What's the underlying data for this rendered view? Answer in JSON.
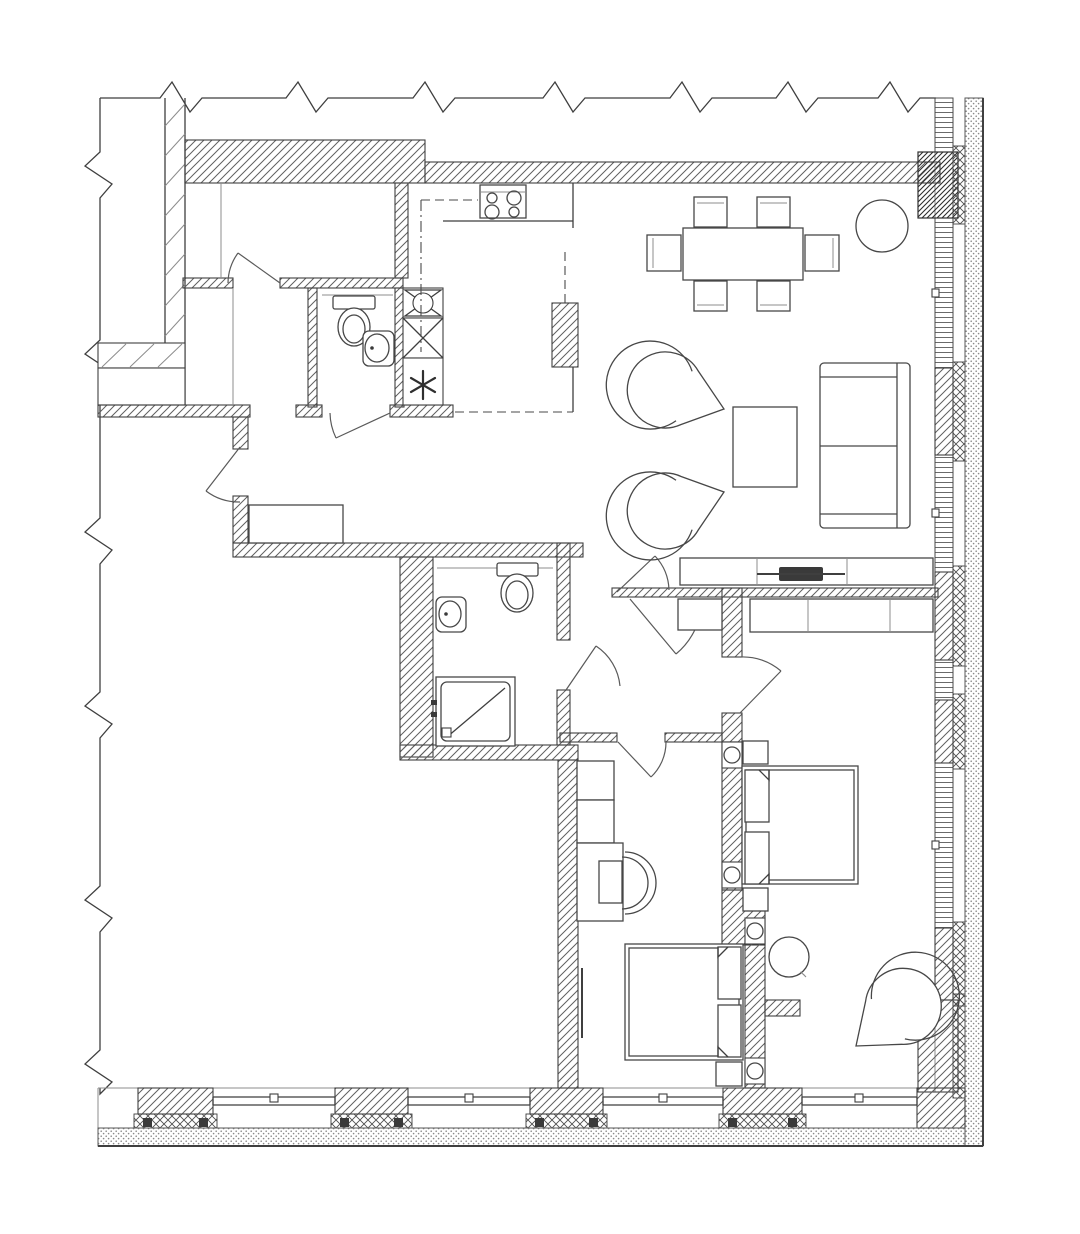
{
  "canvas": {
    "width": 1080,
    "height": 1234
  },
  "palette": {
    "paper": "#ffffff",
    "ink": "#3d3d3d",
    "ink_soft": "#8c8c8c",
    "hatch_line": "#636363",
    "dark_fill": "#3a3a3a"
  },
  "plan": {
    "description": "Apartment floor plan, black-and-white CAD drawing with hatched walls, window facade on right and bottom, break lines on top and left",
    "note_symbol": "six-point-asterisk",
    "wall_legend": [
      {
        "name": "masonry-wall",
        "fill": "diagonal-hatch"
      },
      {
        "name": "structural-pier",
        "fill": "dense-diagonal-hatch"
      },
      {
        "name": "insulation",
        "fill": "cross-hatch"
      },
      {
        "name": "exterior-cladding",
        "fill": "stipple-dots"
      },
      {
        "name": "window-band",
        "fill": "ladder-stripes"
      },
      {
        "name": "drawing-cut",
        "fill": "zigzag-break-line"
      }
    ],
    "fixtures": {
      "kitchen": [
        {
          "item": "cooktop-4-burner",
          "count": 1
        },
        {
          "item": "counter-run",
          "count": 1
        },
        {
          "item": "upper-cabinets-dashed",
          "count": 1
        },
        {
          "item": "ventilation-fan-shaft",
          "count": 1
        },
        {
          "item": "duct-shaft-x",
          "count": 1
        },
        {
          "item": "riser-note-asterisk",
          "count": 1
        },
        {
          "item": "structural-column",
          "count": 1
        }
      ],
      "wc": [
        {
          "item": "toilet",
          "count": 1
        },
        {
          "item": "round-washbasin",
          "count": 1
        }
      ],
      "bathroom": [
        {
          "item": "toilet",
          "count": 1
        },
        {
          "item": "washbasin",
          "count": 1
        },
        {
          "item": "shower-tray-with-diagonal",
          "count": 1
        }
      ],
      "dining": [
        {
          "item": "dining-table",
          "count": 1
        },
        {
          "item": "dining-chair",
          "count": 6
        },
        {
          "item": "round-plant-or-table",
          "count": 1
        }
      ],
      "living": [
        {
          "item": "fan-armchair",
          "count": 2
        },
        {
          "item": "coffee-table",
          "count": 1
        },
        {
          "item": "loveseat-sofa",
          "count": 1
        },
        {
          "item": "tv-console",
          "count": 1
        },
        {
          "item": "tv",
          "count": 1
        }
      ],
      "master_bedroom": [
        {
          "item": "built-in-wardrobe-3-section",
          "count": 1
        },
        {
          "item": "double-bed",
          "count": 1
        },
        {
          "item": "pillow",
          "count": 2
        },
        {
          "item": "nightstand",
          "count": 2
        },
        {
          "item": "round-table",
          "count": 1
        },
        {
          "item": "fan-armchair",
          "count": 1
        }
      ],
      "second_bedroom": [
        {
          "item": "cabinet",
          "count": 2
        },
        {
          "item": "desk",
          "count": 1
        },
        {
          "item": "desk-chair",
          "count": 1
        },
        {
          "item": "double-bed",
          "count": 1
        },
        {
          "item": "pillow",
          "count": 2
        },
        {
          "item": "nightstand",
          "count": 1
        }
      ],
      "hall": [
        {
          "item": "built-in-cabinet",
          "count": 2
        },
        {
          "item": "door-swing",
          "count": 8
        }
      ]
    }
  }
}
